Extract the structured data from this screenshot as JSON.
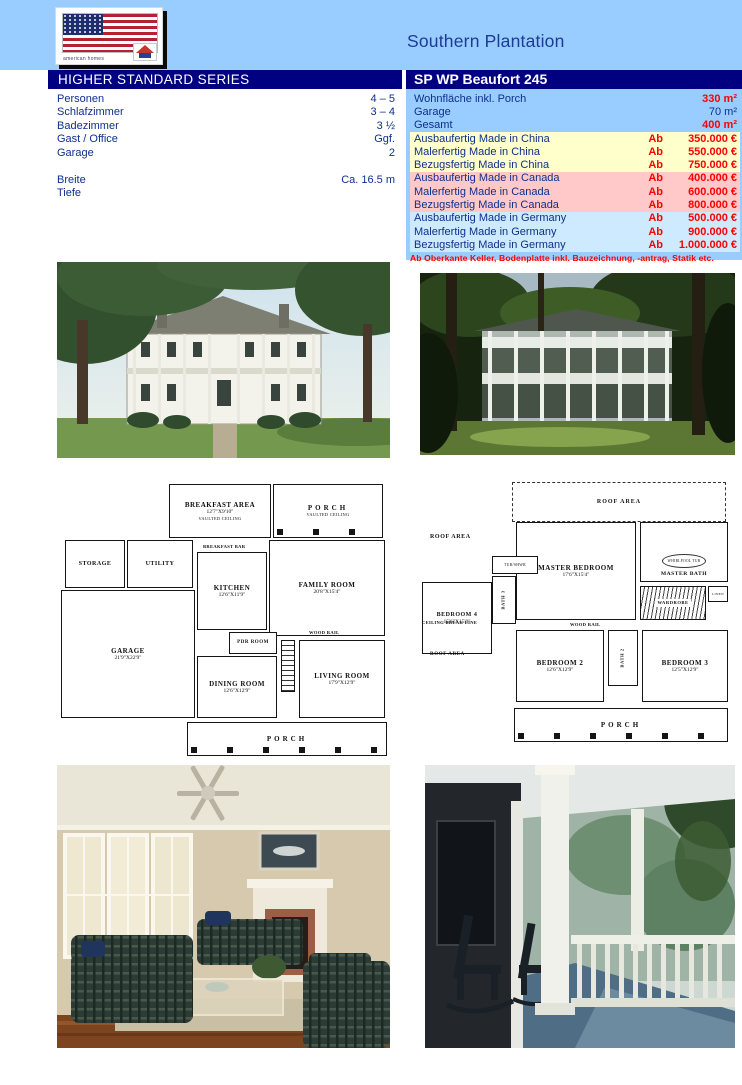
{
  "colors": {
    "page_blue": "#99ccff",
    "bar_navy": "#000080",
    "text_navy": "#0f2f8c",
    "value_red": "#ff0000",
    "row_yellow": "#ffffcc",
    "row_pink": "#ffc9c9",
    "row_lightblue": "#cdeaff"
  },
  "header": {
    "logo_text": "american homes",
    "title": "Southern Plantation"
  },
  "bars": {
    "series": "HIGHER STANDARD SERIES",
    "model": "SP WP Beaufort 245"
  },
  "specs_left": {
    "rows": [
      {
        "label": "Personen",
        "value": "4 – 5"
      },
      {
        "label": "Schlafzimmer",
        "value": "3 – 4"
      },
      {
        "label": "Badezimmer",
        "value": "3 ½"
      },
      {
        "label": "Gast / Office",
        "value": "Ggf."
      },
      {
        "label": "Garage",
        "value": "2"
      },
      {
        "label": "",
        "value": ""
      },
      {
        "label": "Breite",
        "value": "Ca. 16.5 m"
      },
      {
        "label": "Tiefe",
        "value": ""
      }
    ]
  },
  "specs_right": {
    "area_rows": [
      {
        "label": "Wohnfläche inkl. Porch",
        "value": "330 m²"
      },
      {
        "label": "Garage",
        "value": "70 m²"
      },
      {
        "label": "Gesamt",
        "value": "400 m²"
      }
    ],
    "price_rows": [
      {
        "label": "Ausbaufertig Made in China",
        "prefix": "Ab",
        "amount": "350.000 €"
      },
      {
        "label": "Malerfertig Made in China",
        "prefix": "Ab",
        "amount": "550.000 €"
      },
      {
        "label": "Bezugsfertig Made in China",
        "prefix": "Ab",
        "amount": "750.000 €"
      },
      {
        "label": "Ausbaufertig Made in Canada",
        "prefix": "Ab",
        "amount": "400.000 €"
      },
      {
        "label": "Malerfertig Made in Canada",
        "prefix": "Ab",
        "amount": "600.000 €"
      },
      {
        "label": "Bezugsfertig Made in Canada",
        "prefix": "Ab",
        "amount": "800.000 €"
      },
      {
        "label": "Ausbaufertig Made in Germany",
        "prefix": "Ab",
        "amount": "500.000 €"
      },
      {
        "label": "Malerfertig Made in Germany",
        "prefix": "Ab",
        "amount": "900.000 €"
      },
      {
        "label": "Bezugsfertig Made in Germany",
        "prefix": "Ab",
        "amount": "1.000.000 €"
      }
    ],
    "note": "Ab Oberkante Keller, Bodenplatte inkl. Bauzeichnung, -antrag, Statik etc."
  },
  "plan1": {
    "breakfast_name": "BREAKFAST AREA",
    "breakfast_dims": "12'7\"X9'10\"",
    "breakfast_sub": "VAULTED CEILING",
    "porch_top_name": "PORCH",
    "porch_top_sub": "VAULTED CEILING",
    "breakfast_bar": "BREAKFAST BAR",
    "storage": "STORAGE",
    "utility": "UTILITY",
    "garage_name": "GARAGE",
    "garage_dims": "21'9\"X22'9\"",
    "kitchen_name": "KITCHEN",
    "kitchen_dims": "12'6\"X11'9\"",
    "family_name": "FAMILY ROOM",
    "family_dims": "20'8\"X15'4\"",
    "pdr": "PDR ROOM",
    "dining_name": "DINING ROOM",
    "dining_dims": "12'6\"X12'9\"",
    "living_name": "LIVING ROOM",
    "living_dims": "17'9\"X12'9\"",
    "wood_rail": "WOOD RAIL",
    "porch_bottom": "PORCH"
  },
  "plan2": {
    "roof_top": "ROOF AREA",
    "roof_left": "ROOF AREA",
    "master_name": "MASTER BEDROOM",
    "master_dims": "17'6\"X15'4\"",
    "master_bath": "MASTER BATH",
    "whirlpool": "WHIRLPOOL TUB",
    "tub_shwr": "TUB/SHWR",
    "bath3": "BATH 3",
    "bedroom4_name": "BEDROOM 4",
    "bedroom4_dims": "15'6\"X15'0\"",
    "wardrobe": "WARDROBE",
    "linen": "LINEN",
    "ceiling_break": "CEILING BREAK LINE",
    "roof_left2": "ROOF AREA",
    "wood_rail": "WOOD RAIL",
    "bedroom2_name": "BEDROOM 2",
    "bedroom2_dims": "12'6\"X12'9\"",
    "bath2": "BATH 2",
    "bedroom3_name": "BEDROOM 3",
    "bedroom3_dims": "12'5\"X12'9\"",
    "porch": "PORCH"
  }
}
